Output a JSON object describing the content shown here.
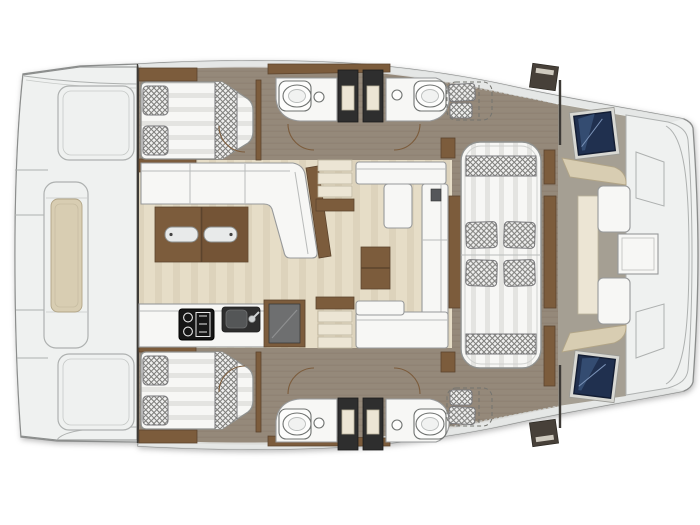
{
  "meta": {
    "title": "Catamaran interior layout plan - top view",
    "diagram_type": "boat floor plan",
    "orientation": "bow to the right, twin hulls top and bottom"
  },
  "colors": {
    "background": "#ffffff",
    "hull_outline": "#8b8d8c",
    "deck_white": "#eff1f0",
    "deck_shade": "#e3e5e4",
    "panel_stroke": "#aeb1b0",
    "bulkhead_dark": "#3d3a36",
    "floor_taupe": "#95897a",
    "floor_taupe_line": "#887c6d",
    "floor_beige": "#e6ddc7",
    "floor_beige_line": "#ddd3bc",
    "fore_gray": "#a59f93",
    "wood_dark": "#5c442d",
    "wood_mid": "#7c5c3c",
    "cushion_white": "#f7f7f5",
    "cushion_shade": "#e4e4e1",
    "cushion_beige": "#d8cdb2",
    "crosshatch_bg": "#efefee",
    "crosshatch_line": "#80807d",
    "appliance_dark": "#2e2e2e",
    "appliance_gray": "#6e6f70",
    "screen_navy": "#20304f",
    "screen_navy_light": "#46658e",
    "step_cream": "#ece5d4",
    "fixture_stroke": "#6f7270"
  },
  "areas": {
    "aft_deck": "Aft deck with long bench seat and lockers",
    "cabin_top": "Double berth cabin, port aft",
    "cabin_bottom": "Double berth cabin, starboard aft",
    "heads_top": "Two head compartments with toilets, basins and shower columns",
    "heads_bottom": "Two head compartments with toilets, basins and shower columns",
    "aft_salon": "L-shaped settee with folding wood table",
    "galley": "Galley with stove, sink and refrigerator",
    "stairs": "Companionway steps",
    "forward_salon": "Lounge settees with coffee table",
    "day_bed": "Large convertible day bed with four cushions",
    "helm": "Navigation screens / deck hatches",
    "forward_cockpit": "Forward cockpit with table and seats at the bow"
  },
  "features": {
    "double_berths": 2,
    "berth_pillows_each": 2,
    "toilets": 4,
    "wash_basins": 4,
    "shower_columns": 4,
    "day_bed_cushions": 4,
    "salon_table_handles": 2,
    "step_count_per_stair": 3,
    "helm_screens": 2,
    "door_swings": 6
  },
  "icons": [
    "stove-icon",
    "sink-icon",
    "fridge-icon",
    "toilet-icon",
    "washbasin-icon",
    "helm-screen-icon",
    "door-swing-icon",
    "shower-area-icon",
    "table-handle-icon"
  ]
}
